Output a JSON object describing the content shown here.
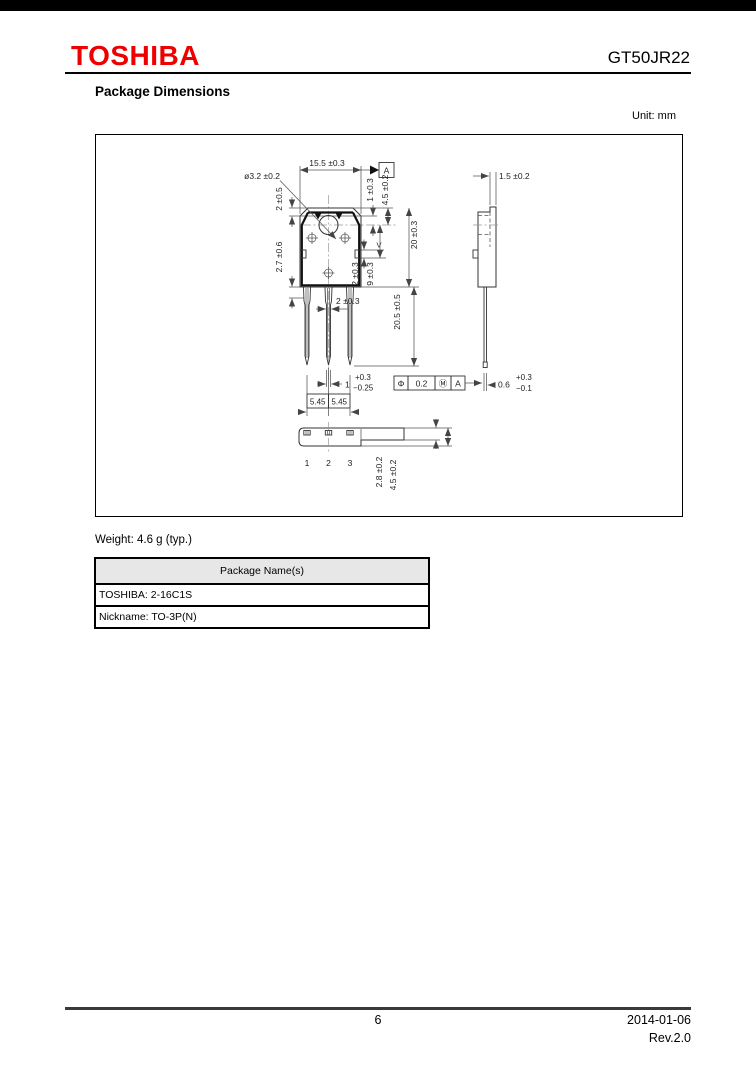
{
  "header": {
    "brand": "TOSHIBA",
    "part_number": "GT50JR22"
  },
  "colors": {
    "brand_red": "#ee0000"
  },
  "section": {
    "title": "Package Dimensions",
    "unit": "Unit: mm"
  },
  "drawing": {
    "front": {
      "width_top": "15.5 ±0.3",
      "datum": "A",
      "hole": "ø3.2 ±0.2",
      "step": "2 ±0.5",
      "step2": "1 ±0.3",
      "hole_offset": "4.5 ±0.2",
      "height": "20 ±0.3",
      "shoulder": "2.7 ±0.6",
      "tab_width": "2 ±0.3",
      "tab_offset": "9 ±0.3",
      "section_mark": "V",
      "lead_width": "2 ±0.3",
      "lead_length": "20.5 ±0.5",
      "lead_thick_val": "1",
      "lead_thick_plus": "+0.3",
      "lead_thick_minus": "−0.25",
      "pitch_left": "5.45",
      "pitch_right": "5.45"
    },
    "tolerance_frame": {
      "sym": "Φ",
      "value": "0.2",
      "modifier": "Ⓜ",
      "datum": "A"
    },
    "bottom": {
      "pins": [
        "1",
        "2",
        "3"
      ],
      "body_thickness": "2.8 ±0.2",
      "overall_thickness": "4.5 ±0.2"
    },
    "side": {
      "tab_thickness": "1.5 ±0.2",
      "lead_tip_val": "0.6",
      "lead_tip_plus": "+0.3",
      "lead_tip_minus": "−0.1"
    }
  },
  "weight_note": "Weight: 4.6 g (typ.)",
  "package_table": {
    "header": "Package Name(s)",
    "rows": [
      "TOSHIBA: 2-16C1S",
      "Nickname: TO-3P(N)"
    ]
  },
  "footer": {
    "page_number": "6",
    "date": "2014-01-06",
    "revision": "Rev.2.0"
  }
}
